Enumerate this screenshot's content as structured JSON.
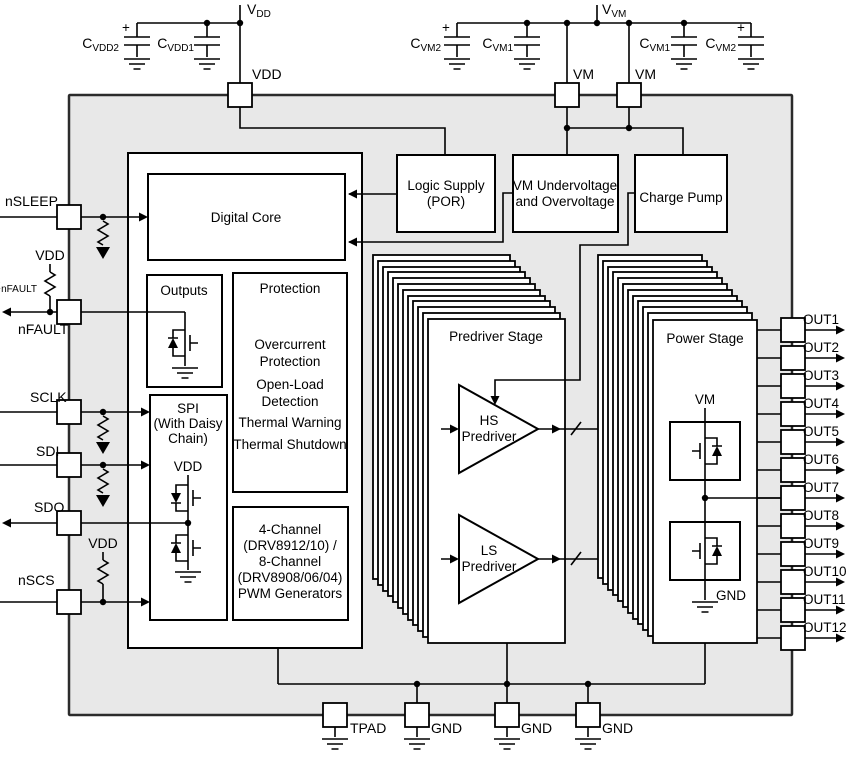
{
  "colors": {
    "chip_fill": "#e8e8e8",
    "line": "#000000",
    "block_fill": "#ffffff"
  },
  "external": {
    "vdd_supply": {
      "main": "V",
      "sub": "DD"
    },
    "vvm_supply": {
      "main": "V",
      "sub": "VM"
    },
    "cap_cvdd2": {
      "main": "C",
      "sub": "VDD2",
      "plus": "+"
    },
    "cap_cvdd1": {
      "main": "C",
      "sub": "VDD1"
    },
    "cap_cvm2_left": {
      "main": "C",
      "sub": "VM2",
      "plus": "+"
    },
    "cap_cvm1_left": {
      "main": "C",
      "sub": "VM1"
    },
    "cap_cvm1_right": {
      "main": "C",
      "sub": "VM1"
    },
    "cap_cvm2_right": {
      "main": "C",
      "sub": "VM2",
      "plus": "+"
    },
    "r_nfault": {
      "main": "R",
      "sub": "nFAULT"
    },
    "vdd_ref_nfault": "VDD",
    "vdd_ref_nscs": "VDD"
  },
  "pins": {
    "top": [
      "VDD",
      "VM",
      "VM"
    ],
    "left": [
      "nSLEEP",
      "nFAULT",
      "SCLK",
      "SDI",
      "SDO",
      "nSCS"
    ],
    "right": [
      "OUT1",
      "OUT2",
      "OUT3",
      "OUT4",
      "OUT5",
      "OUT6",
      "OUT7",
      "OUT8",
      "OUT9",
      "OUT10",
      "OUT11",
      "OUT12"
    ],
    "bottom": [
      "TPAD",
      "GND",
      "GND",
      "GND"
    ]
  },
  "blocks": {
    "digital_core": {
      "label": "Digital Core"
    },
    "logic_supply": {
      "lines": [
        "Logic Supply",
        "(POR)"
      ]
    },
    "vm_monitor": {
      "lines": [
        "VM Undervoltage",
        "and Overvoltage"
      ]
    },
    "charge_pump": {
      "label": "Charge Pump"
    },
    "outputs": {
      "label": "Outputs"
    },
    "protection": {
      "title": "Protection",
      "lines": [
        "Overcurrent",
        "Protection",
        "Open-Load",
        "Detection",
        "Thermal Warning",
        "Thermal Shutdown"
      ]
    },
    "spi": {
      "lines": [
        "SPI",
        "(With Daisy",
        "Chain)"
      ],
      "vdd_label": "VDD"
    },
    "pwm": {
      "lines": [
        "4-Channel",
        "(DRV8912/10) /",
        "8-Channel",
        "(DRV8908/06/04)",
        "PWM Generators"
      ]
    },
    "predriver": {
      "title": "Predriver Stage",
      "hs_lines": [
        "HS",
        "Predriver"
      ],
      "ls_lines": [
        "LS",
        "Predriver"
      ]
    },
    "power": {
      "title": "Power Stage",
      "vm_label": "VM",
      "gnd_label": "GND"
    }
  }
}
